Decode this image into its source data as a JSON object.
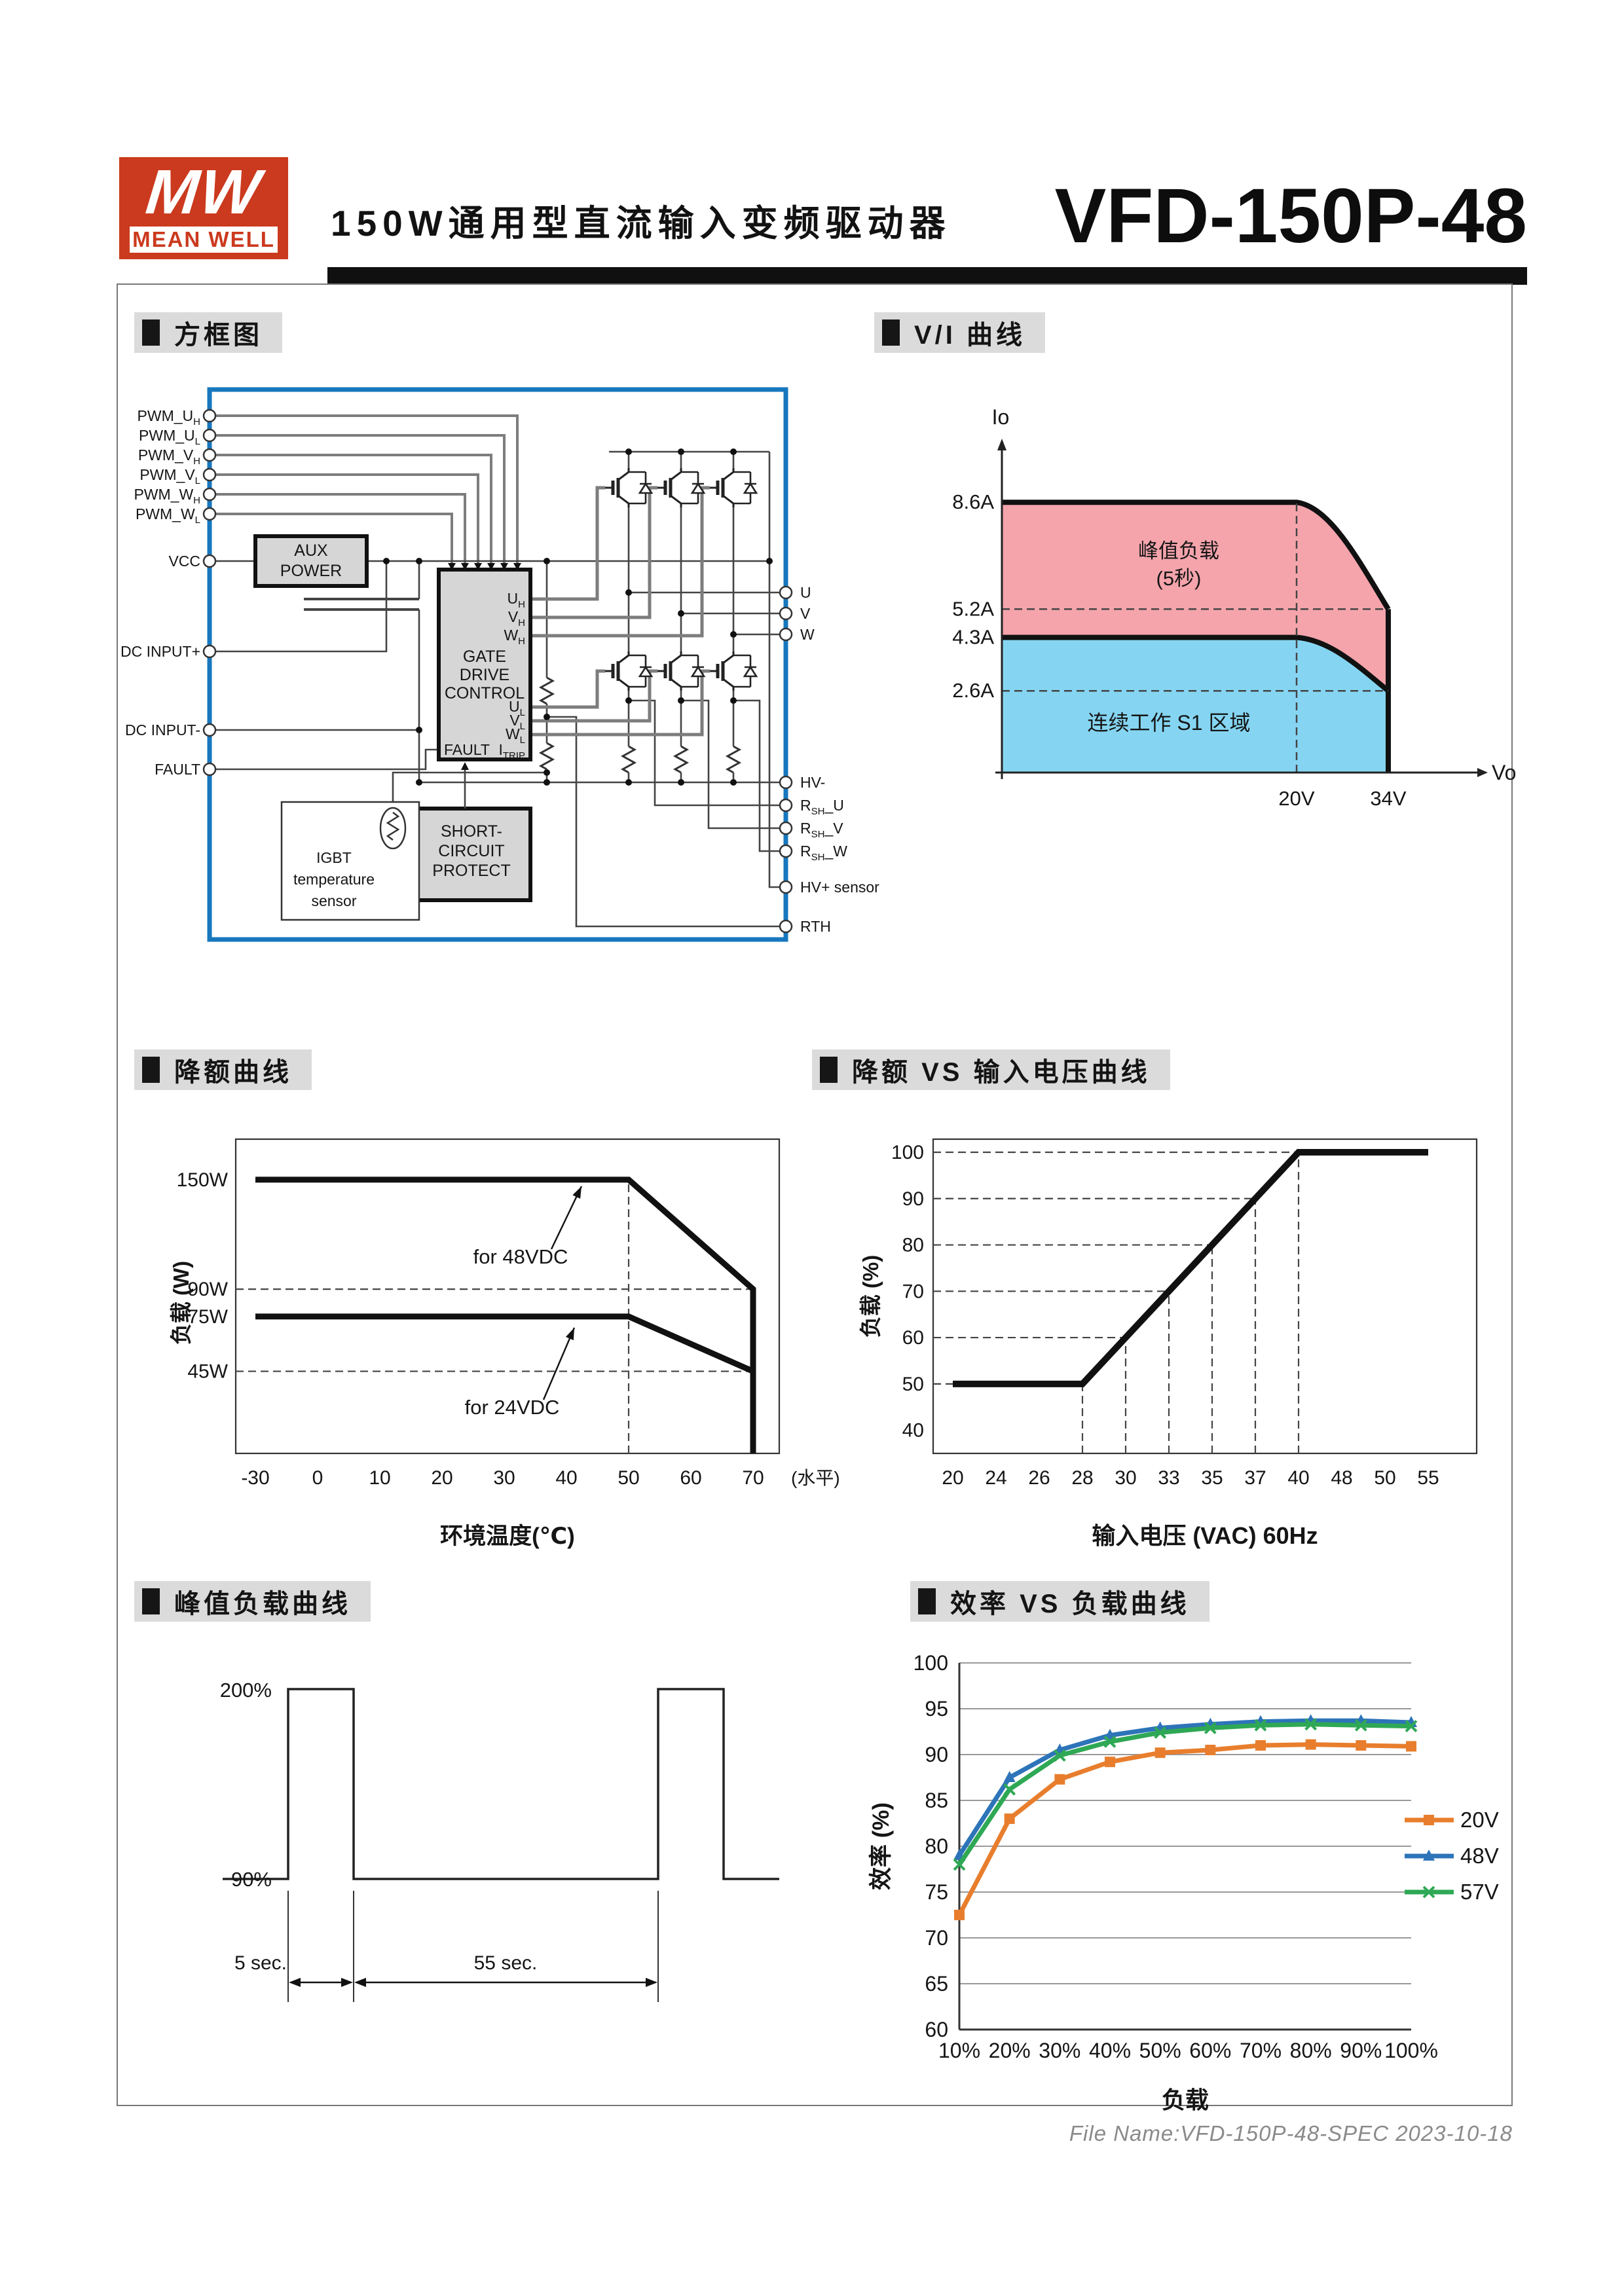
{
  "header": {
    "logo_mw": "MW",
    "logo_text": "MEAN WELL",
    "title": "150W通用型直流输入变频驱动器",
    "model": "VFD-150P-48"
  },
  "sections": [
    {
      "id": "block-diagram",
      "title": "方框图"
    },
    {
      "id": "vi-curve",
      "title": "V/I 曲线"
    },
    {
      "id": "derating",
      "title": "降额曲线"
    },
    {
      "id": "derating-vs-input",
      "title": "降额 VS 输入电压曲线"
    },
    {
      "id": "peak-load",
      "title": "峰值负载曲线"
    },
    {
      "id": "efficiency",
      "title": "效率 VS 负载曲线"
    }
  ],
  "block_diagram": {
    "left_pins": [
      {
        "main": "PWM_U",
        "sub": "H"
      },
      {
        "main": "PWM_U",
        "sub": "L"
      },
      {
        "main": "PWM_V",
        "sub": "H"
      },
      {
        "main": "PWM_V",
        "sub": "L"
      },
      {
        "main": "PWM_W",
        "sub": "H"
      },
      {
        "main": "PWM_W",
        "sub": "L"
      },
      {
        "main": "VCC",
        "sub": ""
      },
      {
        "main": "DC INPUT+",
        "sub": ""
      },
      {
        "main": "DC INPUT-",
        "sub": ""
      },
      {
        "main": "FAULT",
        "sub": ""
      }
    ],
    "right_pins": [
      {
        "main": "U",
        "sub": "",
        "post": ""
      },
      {
        "main": "V",
        "sub": "",
        "post": ""
      },
      {
        "main": "W",
        "sub": "",
        "post": ""
      },
      {
        "main": "HV-",
        "sub": "",
        "post": ""
      },
      {
        "main": "R",
        "sub": "SH",
        "post": "_U"
      },
      {
        "main": "R",
        "sub": "SH",
        "post": "_V"
      },
      {
        "main": "R",
        "sub": "SH",
        "post": "_W"
      },
      {
        "main": "HV+ sensor",
        "sub": "",
        "post": ""
      },
      {
        "main": "RTH",
        "sub": "",
        "post": ""
      }
    ],
    "gate_pins": [
      {
        "main": "U",
        "sub": "H"
      },
      {
        "main": "V",
        "sub": "H"
      },
      {
        "main": "W",
        "sub": "H"
      },
      {
        "main": "U",
        "sub": "L"
      },
      {
        "main": "V",
        "sub": "L"
      },
      {
        "main": "W",
        "sub": "L"
      }
    ],
    "gate_fault": {
      "main": "FAULT",
      "sub": ""
    },
    "gate_itrip": {
      "main": "I",
      "sub": "TRIP"
    },
    "blocks": {
      "aux": [
        "AUX",
        "POWER"
      ],
      "gate": [
        "GATE",
        "DRIVE",
        "CONTROL"
      ],
      "short": [
        "SHORT-",
        "CIRCUIT",
        "PROTECT"
      ],
      "temp": [
        "IGBT",
        "temperature",
        "sensor"
      ]
    }
  },
  "chart_data": [
    {
      "id": "vi-curve",
      "type": "area",
      "title": "V/I 曲线",
      "x_axis_label": "Vo",
      "y_axis_label": "Io",
      "y_ticks": [
        {
          "value": 8.6,
          "label": "8.6A"
        },
        {
          "value": 5.2,
          "label": "5.2A"
        },
        {
          "value": 4.3,
          "label": "4.3A"
        },
        {
          "value": 2.6,
          "label": "2.6A"
        }
      ],
      "x_ticks": [
        {
          "value": 20,
          "label": "20V"
        },
        {
          "value": 34,
          "label": "34V"
        }
      ],
      "peak_limit_points": [
        [
          0,
          8.6
        ],
        [
          20,
          8.6
        ],
        [
          34,
          5.2
        ]
      ],
      "continuous_limit_points": [
        [
          0,
          4.3
        ],
        [
          20,
          4.3
        ],
        [
          34,
          2.6
        ]
      ],
      "regions": [
        {
          "label_lines": [
            "峰值负载",
            "(5秒)"
          ],
          "color": "#F5A4AC"
        },
        {
          "label_lines": [
            "连续工作 S1 区域"
          ],
          "color": "#85D5F2"
        }
      ]
    },
    {
      "id": "derating",
      "type": "line",
      "title": "降额曲线",
      "xlabel": "环境温度(℃)",
      "ylabel": "负载 (W)",
      "x_suffix_label": "(水平)",
      "categories": [
        -30,
        0,
        10,
        20,
        30,
        40,
        50,
        60,
        70
      ],
      "ylim": [
        0,
        165
      ],
      "y_ticks": [
        {
          "value": 150,
          "label": "150W"
        },
        {
          "value": 90,
          "label": "90W"
        },
        {
          "value": 75,
          "label": "75W"
        },
        {
          "value": 45,
          "label": "45W"
        }
      ],
      "series": [
        {
          "name": "for 48VDC",
          "points": [
            [
              -30,
              150
            ],
            [
              50,
              150
            ],
            [
              70,
              90
            ],
            [
              70,
              0
            ]
          ]
        },
        {
          "name": "for 24VDC",
          "points": [
            [
              -30,
              75
            ],
            [
              50,
              75
            ],
            [
              70,
              45
            ]
          ]
        }
      ],
      "dashed_guides": {
        "horizontal": [
          90,
          45
        ],
        "vertical": [
          50
        ]
      }
    },
    {
      "id": "derating-vs-input",
      "type": "line",
      "title": "降额 VS 输入电压曲线",
      "xlabel": "输入电压 (VAC) 60Hz",
      "ylabel": "负载 (%)",
      "categories": [
        20,
        24,
        26,
        28,
        30,
        33,
        35,
        37,
        40,
        48,
        50,
        55
      ],
      "ylim": [
        35,
        103
      ],
      "y_ticks": [
        40,
        50,
        60,
        70,
        80,
        90,
        100
      ],
      "series": [
        {
          "points": [
            [
              20,
              50
            ],
            [
              28,
              50
            ],
            [
              40,
              100
            ],
            [
              55,
              100
            ]
          ]
        }
      ],
      "guides": [
        [
          28,
          50
        ],
        [
          30,
          60
        ],
        [
          33,
          70
        ],
        [
          35,
          80
        ],
        [
          37,
          90
        ],
        [
          40,
          100
        ]
      ]
    },
    {
      "id": "peak-load",
      "type": "pulse",
      "title": "峰值负载曲线",
      "high_label": "200%",
      "low_label": "90%",
      "pulse_duration_label": "5 sec.",
      "rest_duration_label": "55 sec."
    },
    {
      "id": "efficiency",
      "type": "line",
      "title": "效率 VS 负载曲线",
      "xlabel": "负载",
      "ylabel": "效率 (%)",
      "categories": [
        "10%",
        "20%",
        "30%",
        "40%",
        "50%",
        "60%",
        "70%",
        "80%",
        "90%",
        "100%"
      ],
      "ylim": [
        60,
        100
      ],
      "y_ticks": [
        60,
        65,
        70,
        75,
        80,
        85,
        90,
        95,
        100
      ],
      "series": [
        {
          "name": "20V",
          "color": "#E87E2D",
          "marker": "square",
          "values": [
            72.5,
            83,
            87.3,
            89.2,
            90.2,
            90.5,
            91,
            91.1,
            91,
            90.9
          ]
        },
        {
          "name": "48V",
          "color": "#2D74B9",
          "marker": "triangle",
          "values": [
            79,
            87.5,
            90.5,
            92.1,
            92.9,
            93.3,
            93.6,
            93.7,
            93.7,
            93.5
          ]
        },
        {
          "name": "57V",
          "color": "#2FA855",
          "marker": "x",
          "values": [
            78,
            86.2,
            89.9,
            91.4,
            92.4,
            92.9,
            93.2,
            93.3,
            93.2,
            93.1
          ]
        }
      ],
      "legend_position": "right"
    }
  ],
  "footer": {
    "file_info": "File Name:VFD-150P-48-SPEC  2023-10-18"
  }
}
